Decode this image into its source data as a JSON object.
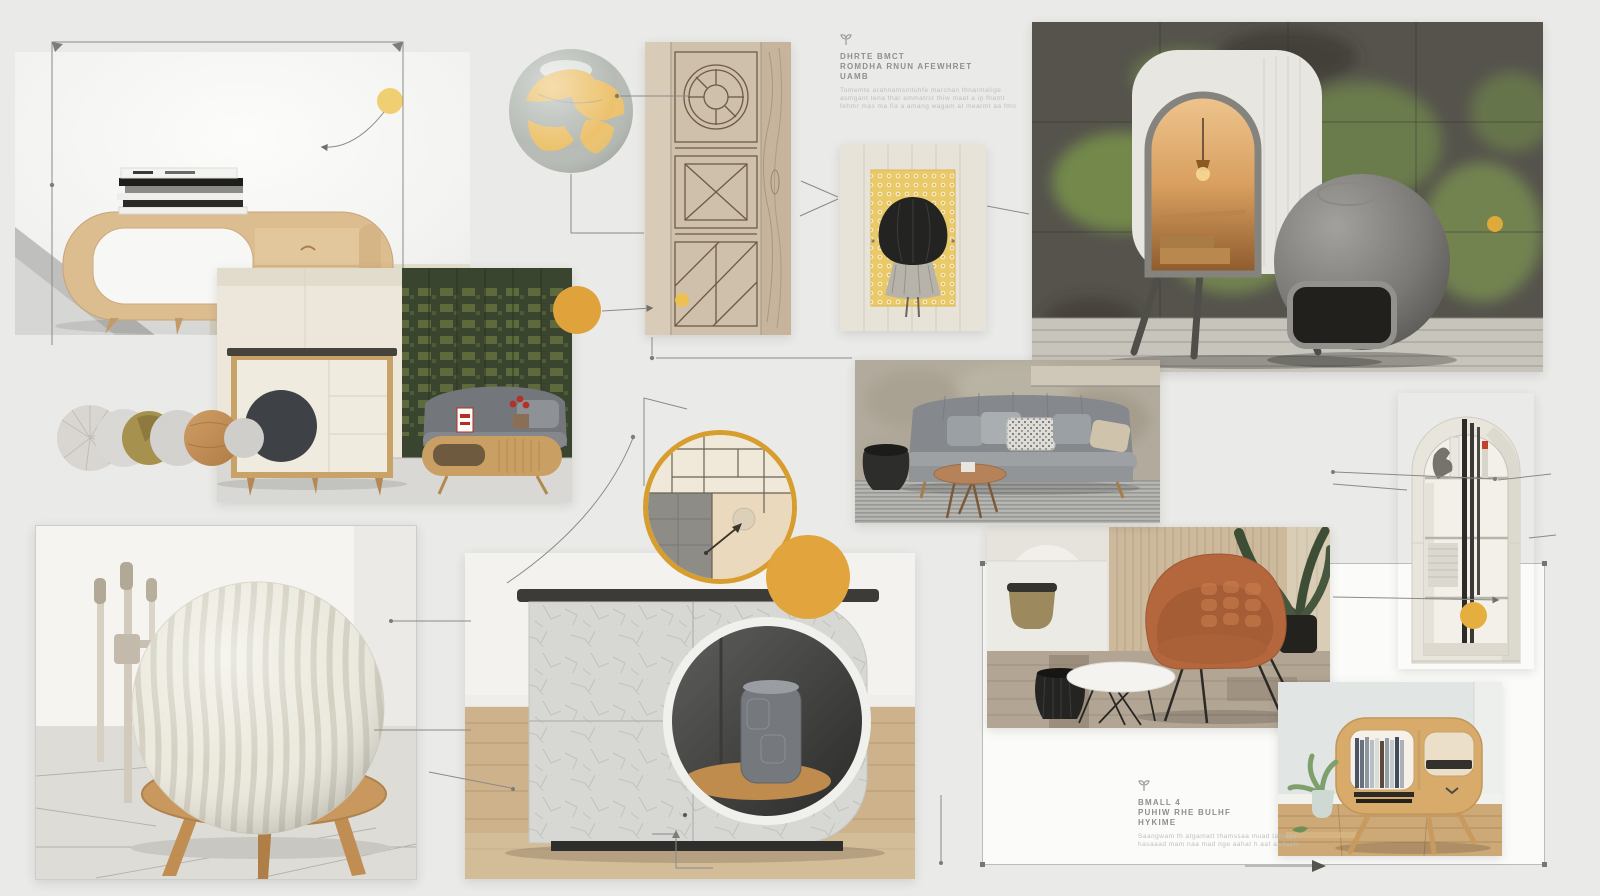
{
  "board": {
    "background": "#eaeae8",
    "accent_yellow": "#e2a43c",
    "accent_yellow_light": "#f0cf72",
    "line_color": "#8a8a87"
  },
  "notes": {
    "top": {
      "icon": "sprout-marker-icon",
      "heading_lines": [
        "DHRTE BMCT",
        "ROMDHA RNUN AFEWHRET",
        "UAMB"
      ],
      "body_lines": [
        "Tomemte arahnamslntuhfe marchan thnarmalige",
        "asmgant tena thar ammatrst thiw maat a ip fhamt",
        "fehmr mas ma fia a amang wagam at mearmt aa fmn"
      ]
    },
    "bottom": {
      "icon": "sprout-marker-icon",
      "heading_lines": [
        "BMALL 4",
        "PUHIW RHE BULHF",
        "HYKIME"
      ],
      "body_lines": [
        "Saangwam th atgamatt thamssaa muad tamagu",
        "hasaaad mam naa mad nge aahat h aat aadaats"
      ]
    }
  },
  "tiles": [
    "wooden-loop-console-photo",
    "globe-illustration",
    "wood-door-sketch",
    "draped-cloth-artwork",
    "acoustic-pod-photo",
    "green-panel-interior-photo",
    "material-swatches",
    "gray-sofa-photo",
    "panel-detail-ring",
    "textured-sphere-stool-photo",
    "crackle-cabinet-photo",
    "leather-chair-photo",
    "arched-bookshelf-photo",
    "wooden-mini-console-photo",
    "selection-card"
  ]
}
